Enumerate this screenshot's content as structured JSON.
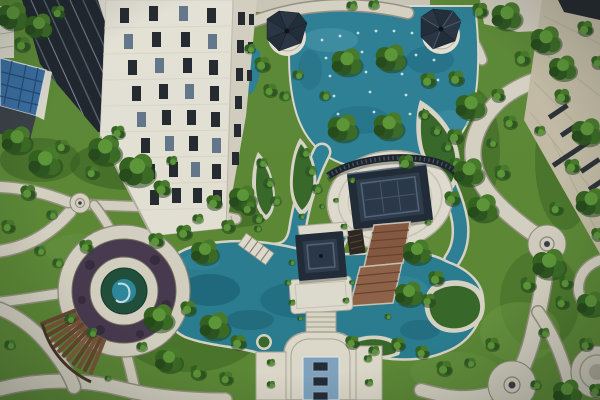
{
  "scene": {
    "type": "aerial-photograph",
    "subject": "Aerial view of a landscaped residential complex courtyard with pools, pavilions and gardens",
    "features": [
      "white high-rise tower with dark windows",
      "dark glass building",
      "small building with blue solar-panel roof",
      "two white gazebos with dark conical roofs",
      "two pavilions with navy hipped roofs and terracotta steps",
      "turquoise pools and streams with planted islands",
      "fountain jets in upper pool",
      "circular plaza with purple planting ring and teal cone sculpture",
      "curved wooden pergola",
      "fountain terrace with three dark basins",
      "winding beige stone paths with circular nodes",
      "beige residential building on the right",
      "dense green trees and hedges"
    ]
  },
  "colors": {
    "grass": "#5f8c36",
    "water": "#2f8398",
    "pond": "#2a8093",
    "path": "#dcd7c7",
    "tower_front": "#ebe7da",
    "tower_side": "#d9d4c4",
    "glass": "#20262e",
    "solar": "#3b6fa3",
    "beige_building": "#c9c0a9",
    "purple": "#4a3a50",
    "teal_sculpture": "#2f8ba0",
    "fountain_pool": "#84a9c6",
    "roof_dark": "#212b38",
    "terracotta": "#8a5a41",
    "wood": "#7a5338"
  }
}
